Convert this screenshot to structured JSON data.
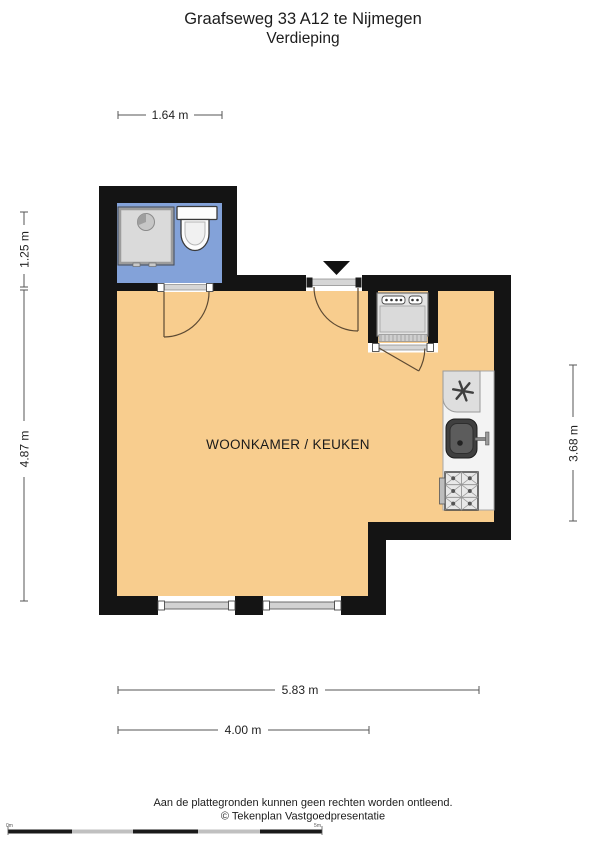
{
  "page": {
    "title": "Graafseweg 33 A12 te Nijmegen",
    "subtitle": "Verdieping"
  },
  "plan": {
    "room_label": "WOONKAMER / KEUKEN",
    "dimensions": {
      "top_width": "1.64 m",
      "left_upper_height": "1.25 m",
      "left_lower_height": "4.87 m",
      "right_height": "3.68 m",
      "bottom_total_width": "5.83 m",
      "bottom_partial_width": "4.00 m"
    },
    "colors": {
      "wall": "#141414",
      "main_floor": "#F8CD8E",
      "bathroom_floor": "#83A2D9",
      "counter": "#F3F3F3",
      "appliance_gray": "#E3E3E3",
      "door_arc": "#5D4A33"
    },
    "fixtures": {
      "bathroom": [
        "shower",
        "toilet"
      ],
      "closet": [
        "washing-machine"
      ],
      "kitchen": [
        "extractor-fan",
        "sink",
        "stove"
      ]
    }
  },
  "footer": {
    "disclaimer": "Aan de plattegronden kunnen geen rechten worden ontleend.",
    "credit": "© Tekenplan Vastgoedpresentatie",
    "scale_bar": {
      "start_label": "0m",
      "end_label": "5m"
    }
  }
}
